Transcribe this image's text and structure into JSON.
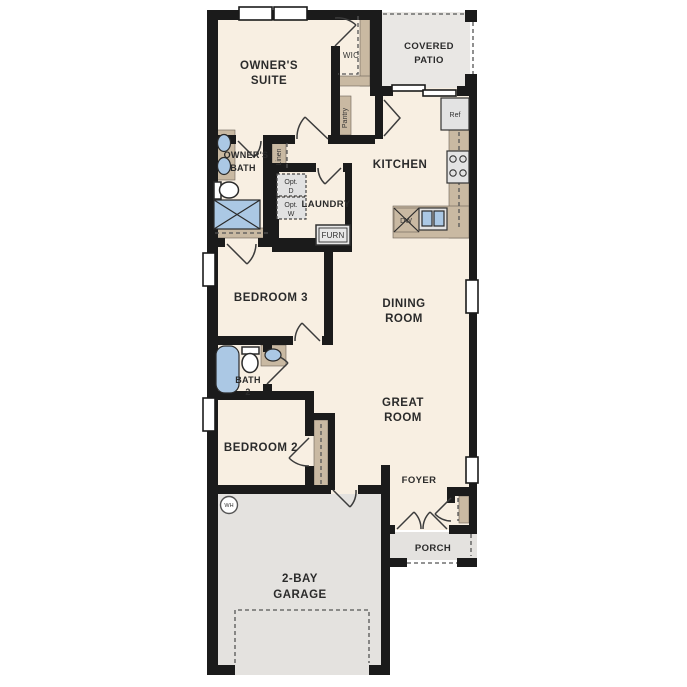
{
  "plan": {
    "labels": {
      "owners_suite": [
        "OWNER'S",
        "SUITE"
      ],
      "wic": "WIC",
      "covered_patio": [
        "COVERED",
        "PATIO"
      ],
      "pantry": "Pantry",
      "ref": "Ref",
      "kitchen": "KITCHEN",
      "owners_bath": [
        "OWNER'S",
        "BATH"
      ],
      "linen": "Linen",
      "opt_dryer": [
        "Opt.",
        "D"
      ],
      "opt_washer": [
        "Opt.",
        "W"
      ],
      "laundry": "LAUNDRY",
      "furnace": "FURN",
      "dishwasher": "DW",
      "bedroom_3": "BEDROOM 3",
      "dining_room": [
        "DINING",
        "ROOM"
      ],
      "bath_2": [
        "BATH",
        "2"
      ],
      "great_room": [
        "GREAT",
        "ROOM"
      ],
      "bedroom_2": "BEDROOM 2",
      "foyer": "FOYER",
      "water_heater": "WH",
      "garage": [
        "2-BAY",
        "GARAGE"
      ],
      "porch": "PORCH"
    },
    "colors": {
      "wall": "#1b1b1b",
      "floor": "#f8efe2",
      "garage_floor": "#e4e2df",
      "patio_floor": "#e9e7e4",
      "cabinet_tan": "#c9b9a2",
      "fixture_blue": "#abc8e4",
      "appliance_gray": "#e3e3e3"
    }
  }
}
